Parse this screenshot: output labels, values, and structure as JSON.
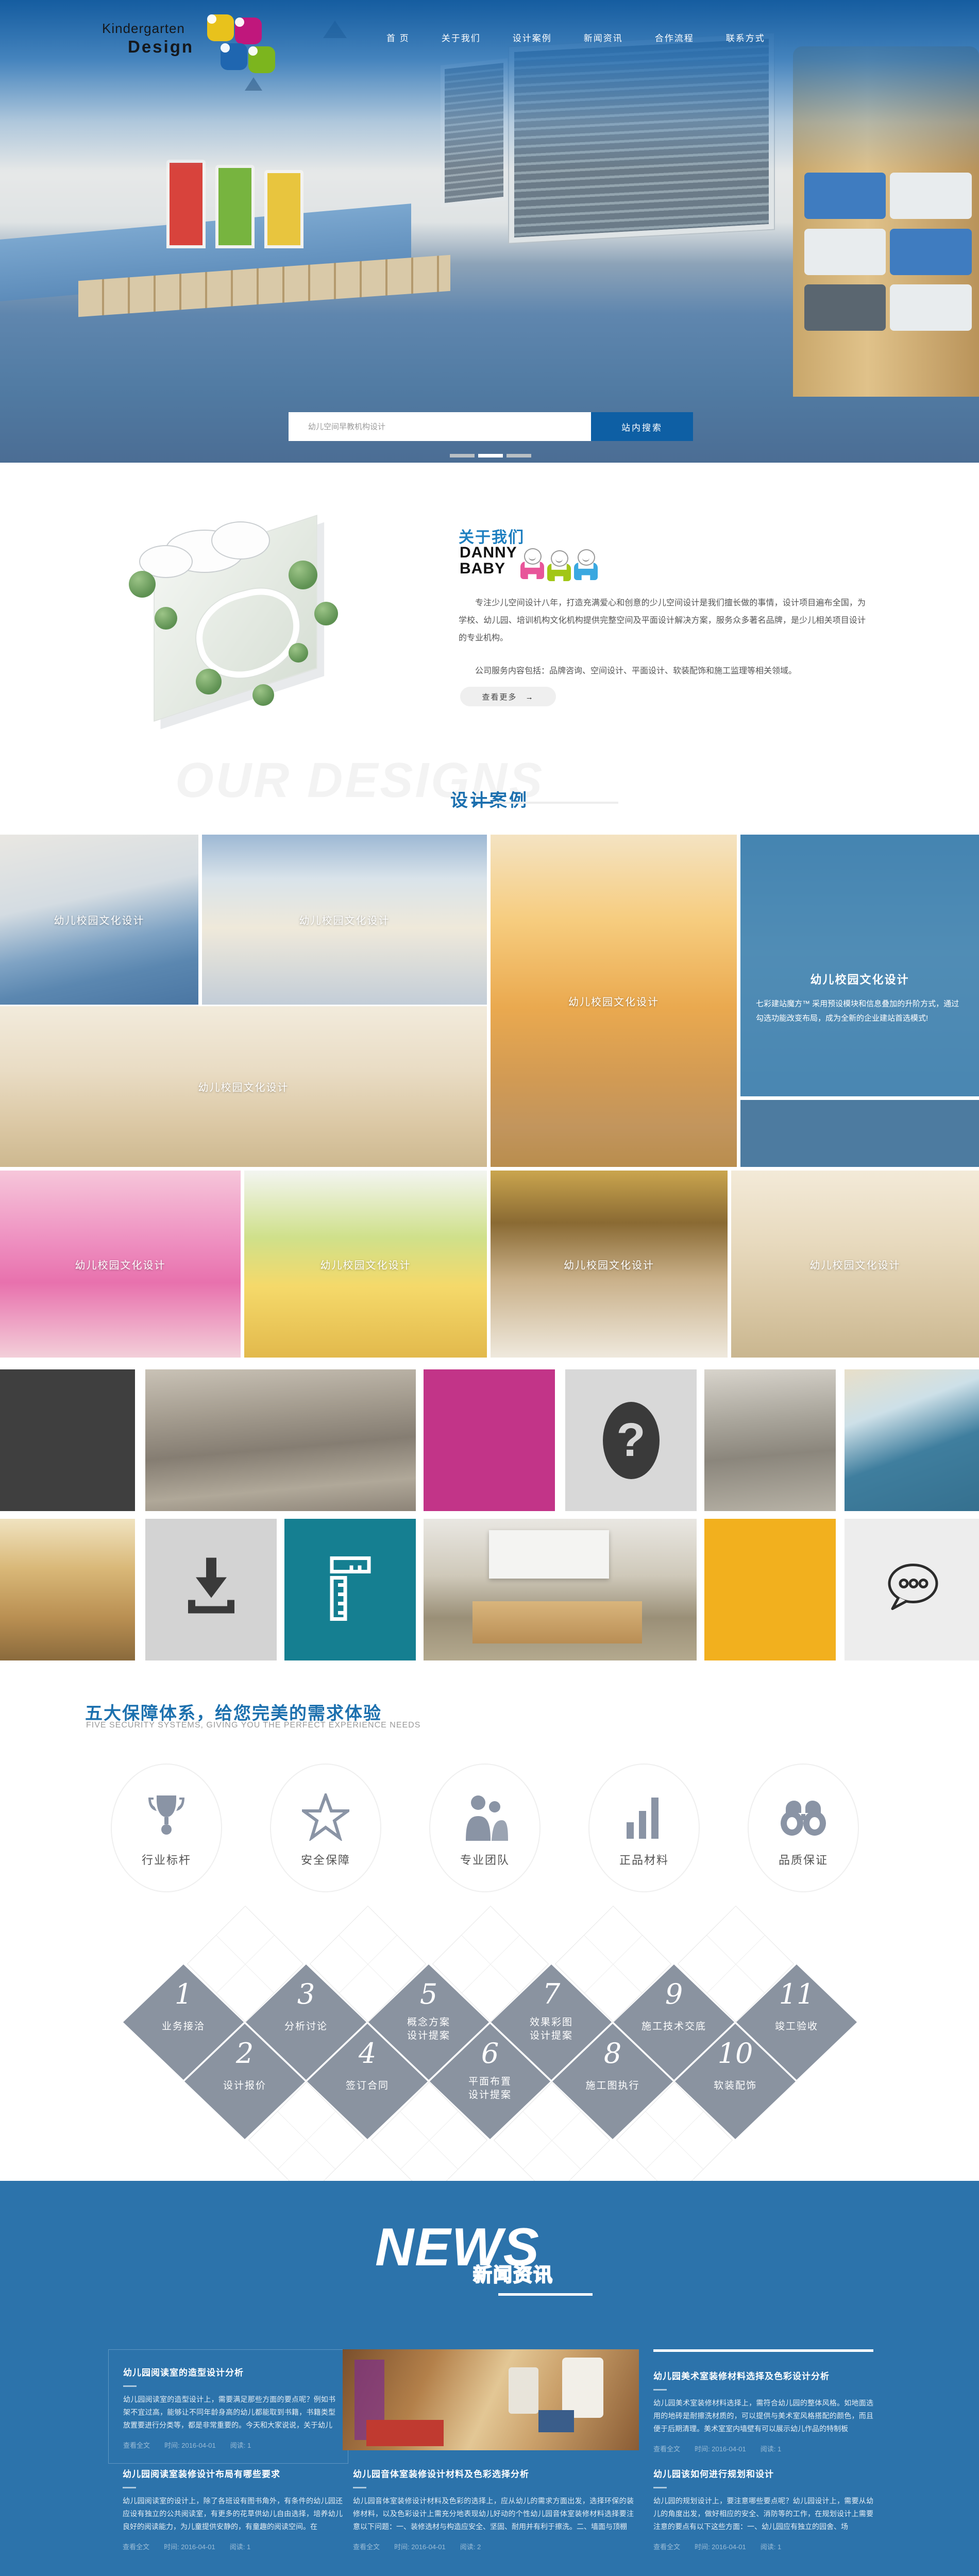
{
  "header": {
    "logo": {
      "line1": "Kindergarten",
      "line2": "Design"
    },
    "nav": [
      "首 页",
      "关于我们",
      "设计案例",
      "新闻资讯",
      "合作流程",
      "联系方式"
    ]
  },
  "hero": {
    "search": {
      "placeholder": "幼儿空间早教机构设计",
      "button": "站内搜索"
    },
    "dots": 3
  },
  "about": {
    "title": "关于我们",
    "brand": {
      "line1": "DANNY",
      "line2": "BABY"
    },
    "p1": "专注少儿空间设计八年，打造充满爱心和创意的少儿空间设计是我们擅长做的事情，设计项目遍布全国，为学校、幼儿园、培训机构文化机构提供完整空间及平面设计解决方案，服务众多著名品牌，是少儿相关项目设计的专业机构。",
    "p2": "公司服务内容包括：品牌咨询、空间设计、平面设计、软装配饰和施工监理等相关领域。",
    "more": "查看更多",
    "more_arrow": "→"
  },
  "cases": {
    "watermark": "OUR DESIGNS",
    "title": "设计案例",
    "caption": "幼儿校园文化设计",
    "tiles": [
      {
        "caption": "幼儿校园文化设计"
      },
      {
        "caption": "幼儿校园文化设计"
      },
      {
        "caption": "幼儿校园文化设计"
      },
      {
        "caption": "幼儿校园文化设计"
      },
      {
        "caption": "幼儿校园文化设计"
      },
      {
        "caption": "幼儿校园文化设计"
      },
      {
        "caption": "幼儿校园文化设计"
      },
      {
        "caption": "幼儿校园文化设计"
      }
    ],
    "featured": {
      "title": "幼儿校园文化设计",
      "desc": "七彩建站魔方™ 采用预设模块和信息叠加的升阶方式，通过勾选功能改变布局，成为全新的企业建站首选模式!"
    }
  },
  "mosaic": {
    "question": "?",
    "speech_dots": "ooo"
  },
  "guarantee": {
    "title": "五大保障体系，给您完美的需求体验",
    "subtitle": "FIVE SECURITY SYSTEMS, GIVING YOU THE PERFECT EXPERIENCE NEEDS",
    "items": [
      {
        "label": "行业标杆",
        "icon": "trophy-icon"
      },
      {
        "label": "安全保障",
        "icon": "star-icon"
      },
      {
        "label": "专业团队",
        "icon": "team-icon"
      },
      {
        "label": "正品材料",
        "icon": "chart-icon"
      },
      {
        "label": "品质保证",
        "icon": "binoculars-icon"
      }
    ]
  },
  "process": {
    "steps": [
      {
        "num": "1",
        "label": "业务接洽"
      },
      {
        "num": "2",
        "label": "设计报价"
      },
      {
        "num": "3",
        "label": "分析讨论"
      },
      {
        "num": "4",
        "label": "签订合同"
      },
      {
        "num": "5",
        "label": "概念方案",
        "label2": "设计提案"
      },
      {
        "num": "6",
        "label": "平面布置",
        "label2": "设计提案"
      },
      {
        "num": "7",
        "label": "效果彩图",
        "label2": "设计提案"
      },
      {
        "num": "8",
        "label": "施工图执行"
      },
      {
        "num": "9",
        "label": "施工技术交底"
      },
      {
        "num": "10",
        "label": "软装配饰"
      },
      {
        "num": "11",
        "label": "竣工验收"
      }
    ]
  },
  "news": {
    "title_en": "NEWS",
    "title_cn": "新闻资讯",
    "articles": [
      {
        "title": "幼儿园阅读室的造型设计分析",
        "body": "幼儿园阅读室的造型设计上，需要满足那些方面的要点呢？例如书架不宜过高，能够让不同年龄身高的幼儿都能取到书籍，书籍类型放置要进行分类等，都是非常重要的。今天和大家说说，关于幼儿",
        "link": "查看全文",
        "time": "时间: 2016-04-01",
        "views": "阅读: 1"
      },
      {
        "title": "幼儿园美术室装修材料选择及色彩设计分析",
        "body": "幼儿园美术室装修材料选择上，需符合幼儿园的整体风格。如地面选用的地砖是耐擦洗材质的，可以提供与美术室风格搭配的颜色，而且便于后期清理。美术室室内墙壁有可以展示幼儿作品的特制板",
        "link": "查看全文",
        "time": "时间: 2016-04-01",
        "views": "阅读: 1"
      },
      {
        "title": "幼儿园阅读室装修设计布局有哪些要求",
        "body": "幼儿园阅读室的设计上，除了各班设有图书角外，有条件的幼儿园还应设有独立的公共阅读室，有更多的花草供幼儿自由选择，培养幼儿良好的阅读能力，为儿童提供安静的，有童趣的阅读空间。在",
        "link": "查看全文",
        "time": "时间: 2016-04-01",
        "views": "阅读: 1"
      },
      {
        "title": "幼儿园音体室装修设计材料及色彩选择分析",
        "body": "幼儿园音体室装修设计材料及色彩的选择上，应从幼儿的需求方面出发，选择环保的装修材料，以及色彩设计上需充分地表现幼儿好动的个性幼儿园音体室装修材料选择要注意以下问题：一、装修选材与构造应安全、坚固、耐用并有利于擦洗。二、墙面与顶棚",
        "link": "查看全文",
        "time": "时间: 2016-04-01",
        "views": "阅读: 2"
      },
      {
        "title": "幼儿园该如何进行规划和设计",
        "body": "幼儿园的规划设计上，要注意哪些要点呢？幼儿园设计上，需要从幼儿的角度出发，做好相应的安全、消防等的工作，在规划设计上需要注意的要点有以下这些方面：一、幼儿园应有独立的园舍、场",
        "link": "查看全文",
        "time": "时间: 2016-04-01",
        "views": "阅读: 1"
      }
    ]
  },
  "colors": {
    "primary_blue": "#1c70ae",
    "news_bg": "#2c73ab",
    "search_btn": "#0e5fa4",
    "magenta_tile": "#c23488",
    "teal_tile": "#157f91",
    "yellow_tile": "#f2b01e",
    "dark_tile": "#3f3f3f"
  }
}
